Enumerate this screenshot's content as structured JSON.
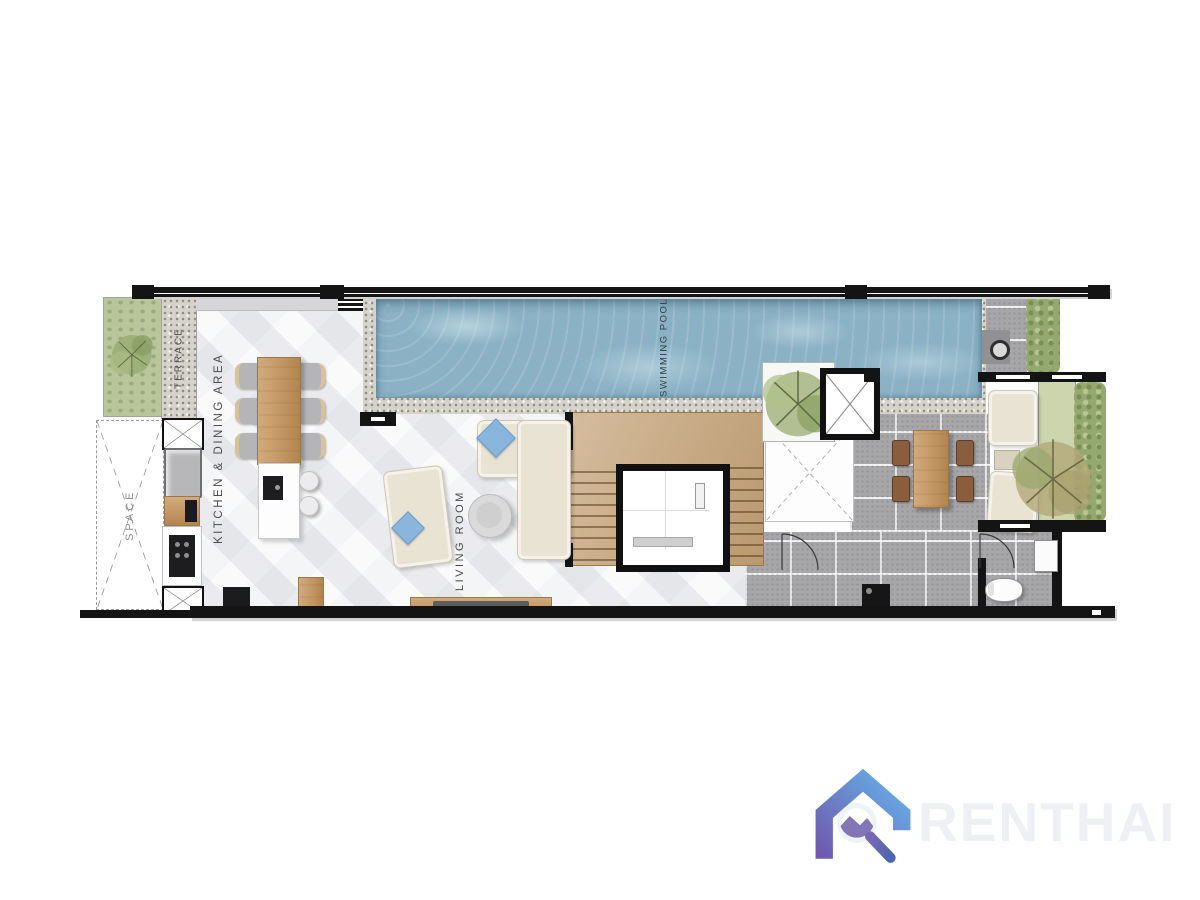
{
  "plan": {
    "labels": {
      "terrace": "TERRACE",
      "kitchen_dining": "KITCHEN & DINING AREA",
      "space": "SPACE",
      "living_room": "LIVING ROOM",
      "swimming_pool": "SWIMMING POOL"
    },
    "colors": {
      "wall": "#141414",
      "floor": "#f2f2f4",
      "pool_water": "#8ab1c4",
      "patio_tile": "#a7a7a9",
      "pebble": "#d6d3ca",
      "wood": "#c39763",
      "garden_green": "#b9c69c",
      "hedge_green": "#94a871",
      "grass_green": "#ccd5ad",
      "sofa_cream": "#e9e3d4",
      "pillow_blue": "#8ab6dd",
      "label_text": "#4c4c4c"
    }
  },
  "watermark": {
    "brand": "RENTHAI",
    "text_color": "#eff0f3",
    "logo": {
      "name": "house-magnifier",
      "gradient_top": "#66b0e8",
      "gradient_bottom": "#6f59ad",
      "handle": "#5a51a4",
      "lens": "#ffffff"
    }
  }
}
